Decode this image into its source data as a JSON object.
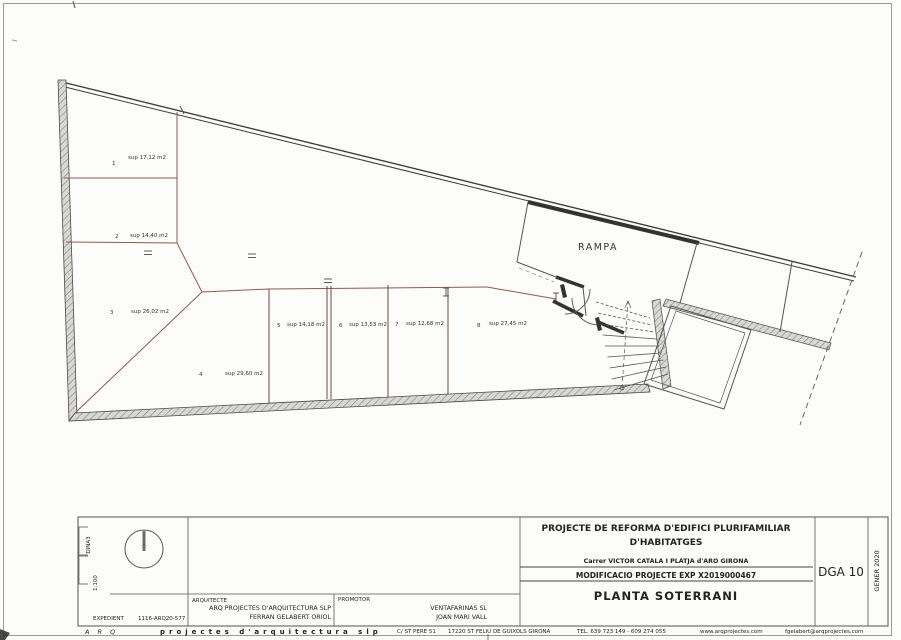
{
  "colors": {
    "wall": "#3a3a3a",
    "partition": "#96564c",
    "paper": "#fcfcfa",
    "hatch_fill": "#d8d8d4",
    "hatch_line": "#8f8f89"
  },
  "plan": {
    "ramp_label": "RAMPA",
    "spaces": [
      {
        "num": "1",
        "area": "sup 17,12 m2"
      },
      {
        "num": "2",
        "area": "sup 14,40 m2"
      },
      {
        "num": "3",
        "area": "sup 26,02 m2"
      },
      {
        "num": "4",
        "area": "sup 29,60 m2"
      },
      {
        "num": "5",
        "area": "sup 14,18 m2"
      },
      {
        "num": "6",
        "area": "sup 13,53 m2"
      },
      {
        "num": "7",
        "area": "sup 12,68 m2"
      },
      {
        "num": "8",
        "area": "sup 27,45 m2"
      }
    ]
  },
  "title_block": {
    "project_line1": "PROJECTE DE REFORMA D'EDIFICI PLURIFAMILIAR",
    "project_line2": "D'HABITATGES",
    "address": "Carrer VICTOR CATALA I    PLATJA d'ARO    GIRONA",
    "modification": "MODIFICACIO PROJECTE   EXP X2019000467",
    "sheet_title": "PLANTA SOTERRANI",
    "sheet_code": "DGA 10",
    "date": "GENER 2020",
    "paper_size": "DINA3",
    "scale": "1:100",
    "expedient_label": "EXPEDIENT",
    "expedient_value": "1116-ARQ20-577",
    "architect_label": "ARQUITECTE",
    "architect_name": "ARQ PROJECTES D'ARQUITECTURA SLP",
    "architect_person": "FERRAN GELABERT ORIOL",
    "promoter_label": "PROMOTOR",
    "promoter_name": "VENTAFARINAS SL",
    "promoter_person": "JOAN MARI VALL"
  },
  "footer": {
    "brand": "A R Q",
    "firm": "projectes d'arquitectura slp",
    "address": "C/ ST PERE 51",
    "city": "17220 ST FELIU DE GUIXOLS   GIRONA",
    "phone": "TEL. 639 723 149  -  609 274 055",
    "web": "www.arqprojectes.com",
    "email": "fgelabert@arqprojectes.com"
  }
}
